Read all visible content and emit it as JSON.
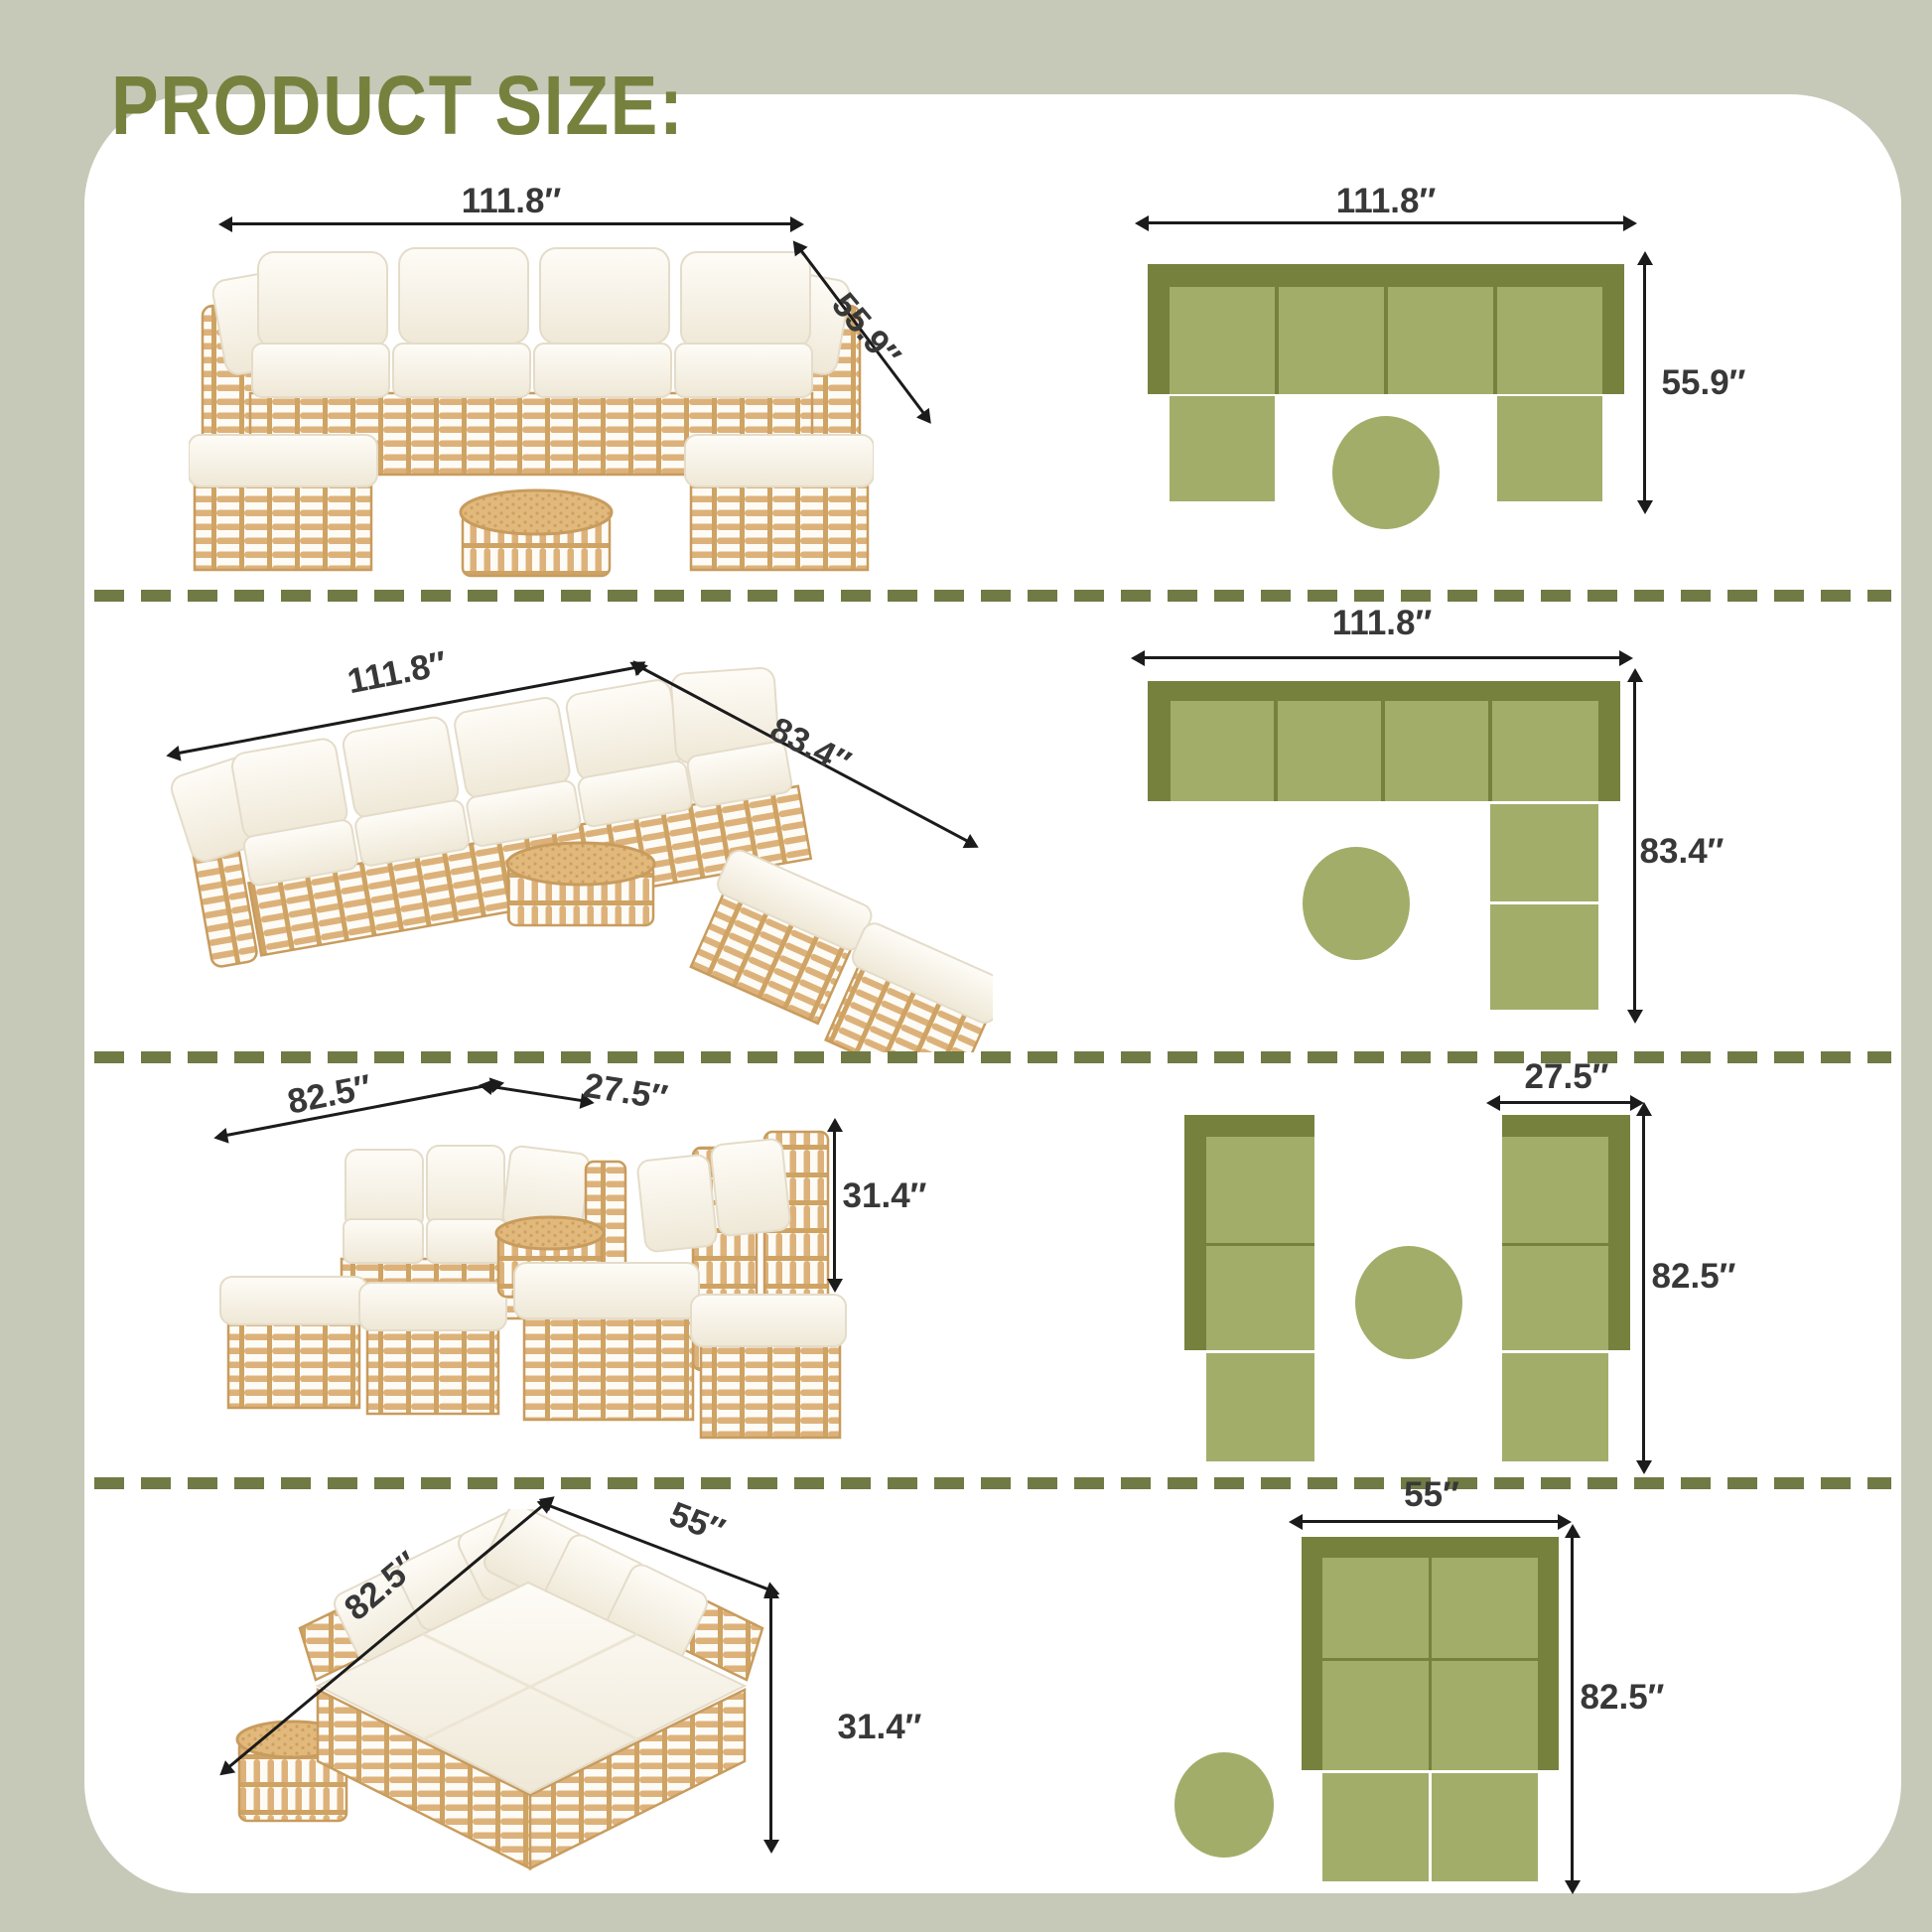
{
  "title": "PRODUCT SIZE:",
  "colors": {
    "background": "#c6c9b7",
    "card": "#ffffff",
    "title_green": "#76813e",
    "divider_green": "#6f7a44",
    "frame_dark_green": "#76813d",
    "seat_light_green": "#a3ad6a",
    "dimension_text": "#383838",
    "arrow_black": "#1b1b1b",
    "rattan_tan": "#ddb27a",
    "cushion_ivory": "#faf7ef"
  },
  "rows": [
    {
      "config": "u-shape-sectional-with-round-table",
      "photo": {
        "width": "111.8″",
        "depth": "55.9″"
      },
      "top_view": {
        "width": "111.8″",
        "depth": "55.9″",
        "seats": 4,
        "ottomans": 2,
        "tables": 1
      }
    },
    {
      "config": "l-shape-sectional-with-round-table",
      "photo": {
        "width": "111.8″",
        "depth": "83.4″"
      },
      "top_view": {
        "width": "111.8″",
        "depth": "83.4″",
        "seats": 6,
        "tables": 1
      }
    },
    {
      "config": "two-facing-sofas-with-side-table",
      "photo": {
        "length": "82.5″",
        "width": "27.5″",
        "height": "31.4″"
      },
      "top_view": {
        "width": "27.5″",
        "length": "82.5″",
        "seats": 6,
        "tables": 1
      }
    },
    {
      "config": "daybed-with-side-table",
      "photo": {
        "length": "82.5″",
        "width": "55″",
        "height": "31.4″"
      },
      "top_view": {
        "width": "55″",
        "length": "82.5″",
        "seats": 6,
        "tables": 1
      }
    }
  ]
}
